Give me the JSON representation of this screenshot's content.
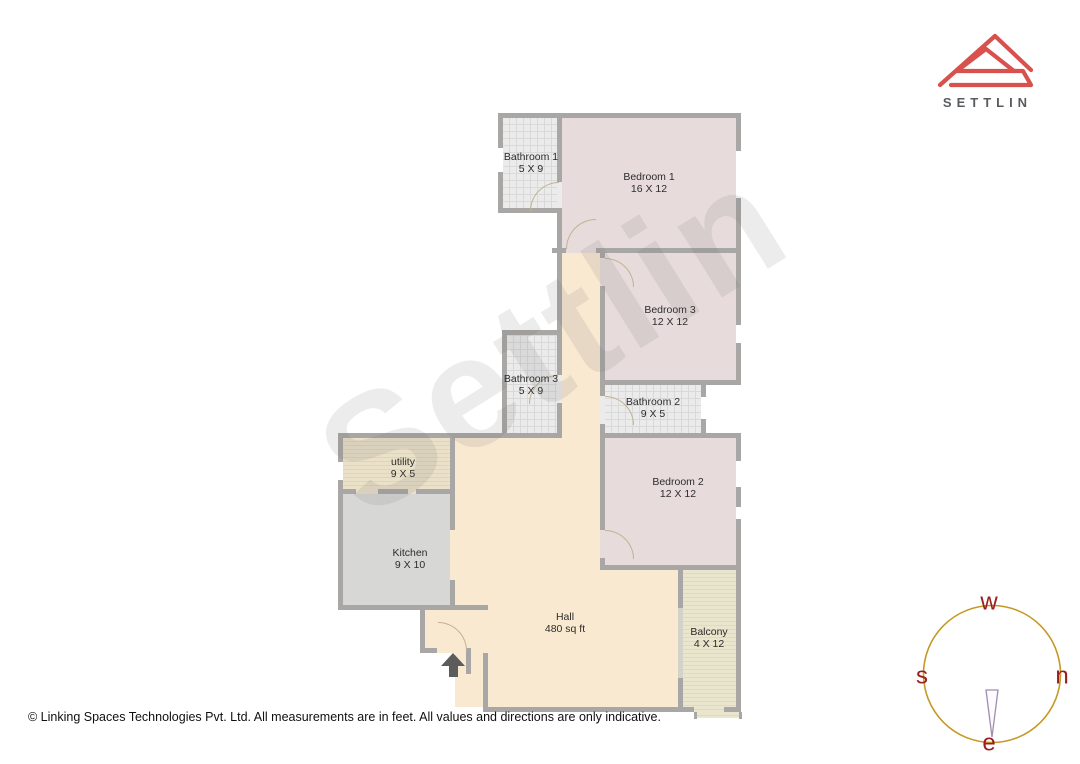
{
  "logo": {
    "brand": "SETTLIN",
    "icon_color": "#d8514c",
    "text_color": "#585c61"
  },
  "watermark": {
    "text": "Settlin"
  },
  "footer": {
    "copyright": "© Linking Spaces Technologies Pvt. Ltd. All measurements are in feet. All values and directions are only indicative."
  },
  "compass": {
    "labels": {
      "top": "w",
      "right": "n",
      "left": "s",
      "bottom": "e"
    },
    "circle_color": "#c49a24",
    "letter_color": "#9c1d1d",
    "needle_color": "#a18daf"
  },
  "floorplan": {
    "colors": {
      "wall": "#a8a7a5",
      "glass": "#d4d3ca",
      "arc": "#c2b294",
      "bedroom": "#e7dcdb",
      "bathroom": "#ebebeb",
      "bathroom_line": "#d9d9d9",
      "hall": "#f9e9d1",
      "utility": "#eae1c8",
      "utility_line": "#ded5b9",
      "kitchen": "#d7d7d6",
      "balcony": "#eae5cd",
      "balcony_line": "#ded9c1",
      "white": "#ffffff"
    },
    "rooms": [
      {
        "id": "bathroom-1",
        "type": "bathroom",
        "rect": [
          503,
          118,
          54,
          90
        ],
        "label": "Bathroom 1",
        "dims": "5 X 9",
        "label_xy": [
          531,
          152
        ]
      },
      {
        "id": "bedroom-1",
        "type": "bedroom",
        "rect": [
          562,
          118,
          174,
          130
        ],
        "label": "Bedroom 1",
        "dims": "16 X 12",
        "label_xy": [
          649,
          172
        ]
      },
      {
        "id": "corridor",
        "type": "hall",
        "rect": [
          562,
          253,
          38,
          185
        ]
      },
      {
        "id": "bedroom-3",
        "type": "bedroom",
        "rect": [
          605,
          253,
          131,
          127
        ],
        "label": "Bedroom 3",
        "dims": "12 X 12",
        "label_xy": [
          670,
          305
        ]
      },
      {
        "id": "bathroom-3",
        "type": "bathroom",
        "rect": [
          507,
          335,
          50,
          98
        ],
        "label": "Bathroom 3",
        "dims": "5 X 9",
        "label_xy": [
          531,
          374
        ]
      },
      {
        "id": "bathroom-2",
        "type": "bathroom",
        "rect": [
          605,
          385,
          96,
          48
        ],
        "label": "Bathroom 2",
        "dims": "9 X 5",
        "label_xy": [
          653,
          397
        ]
      },
      {
        "id": "bedroom-2",
        "type": "bedroom",
        "rect": [
          605,
          438,
          131,
          127
        ],
        "label": "Bedroom 2",
        "dims": "12 X 12",
        "label_xy": [
          678,
          477
        ]
      },
      {
        "id": "utility",
        "type": "utility",
        "rect": [
          343,
          438,
          107,
          51
        ],
        "label": "utility",
        "dims": "9 X 5",
        "label_xy": [
          403,
          457
        ]
      },
      {
        "id": "kitchen",
        "type": "kitchen",
        "rect": [
          343,
          494,
          107,
          111
        ],
        "label": "Kitchen",
        "dims": "9 X 10",
        "label_xy": [
          410,
          548
        ]
      },
      {
        "id": "hall-upper",
        "type": "hall",
        "rect": [
          455,
          438,
          145,
          132
        ]
      },
      {
        "id": "hall-main",
        "type": "hall",
        "rect": [
          455,
          570,
          223,
          137
        ],
        "label": "Hall",
        "dims": "480 sq ft",
        "label_xy": [
          565,
          612
        ]
      },
      {
        "id": "kitchen-doorway",
        "type": "hall",
        "rect": [
          450,
          530,
          5,
          50
        ]
      },
      {
        "id": "vestibule",
        "type": "hall",
        "rect": [
          425,
          610,
          63,
          40
        ]
      },
      {
        "id": "balcony",
        "type": "balcony",
        "rect": [
          683,
          570,
          53,
          142
        ],
        "label": "Balcony",
        "dims": "4 X 12",
        "label_xy": [
          709,
          627
        ]
      },
      {
        "id": "balcony-ledge",
        "type": "balcony",
        "rect": [
          696,
          712,
          46,
          6
        ]
      }
    ],
    "walls": [
      [
        498,
        113,
        243,
        5
      ],
      [
        498,
        208,
        64,
        5
      ],
      [
        552,
        248,
        14,
        5
      ],
      [
        596,
        248,
        145,
        5
      ],
      [
        502,
        330,
        60,
        5
      ],
      [
        600,
        380,
        141,
        5
      ],
      [
        338,
        433,
        224,
        5
      ],
      [
        600,
        433,
        141,
        5
      ],
      [
        338,
        489,
        18,
        5
      ],
      [
        378,
        489,
        30,
        5
      ],
      [
        416,
        489,
        39,
        5
      ],
      [
        600,
        565,
        141,
        5
      ],
      [
        338,
        605,
        150,
        5
      ],
      [
        420,
        648,
        17,
        5
      ],
      [
        483,
        707,
        211,
        5
      ],
      [
        724,
        707,
        17,
        5
      ],
      [
        498,
        113,
        5,
        35
      ],
      [
        498,
        172,
        5,
        41
      ],
      [
        557,
        113,
        5,
        69
      ],
      [
        557,
        208,
        5,
        167
      ],
      [
        557,
        403,
        5,
        35
      ],
      [
        502,
        330,
        5,
        108
      ],
      [
        600,
        253,
        5,
        5
      ],
      [
        600,
        286,
        5,
        110
      ],
      [
        600,
        424,
        5,
        106
      ],
      [
        600,
        558,
        5,
        12
      ],
      [
        701,
        385,
        5,
        12
      ],
      [
        701,
        419,
        5,
        19
      ],
      [
        736,
        113,
        5,
        38
      ],
      [
        736,
        198,
        5,
        127
      ],
      [
        736,
        343,
        5,
        42
      ],
      [
        736,
        438,
        5,
        23
      ],
      [
        736,
        487,
        5,
        20
      ],
      [
        736,
        519,
        5,
        193
      ],
      [
        338,
        433,
        5,
        29
      ],
      [
        338,
        480,
        5,
        125
      ],
      [
        450,
        433,
        5,
        97
      ],
      [
        450,
        580,
        5,
        25
      ],
      [
        420,
        605,
        5,
        45
      ],
      [
        466,
        648,
        5,
        26
      ],
      [
        483,
        653,
        5,
        59
      ],
      [
        678,
        565,
        5,
        43
      ],
      [
        678,
        678,
        5,
        34
      ],
      [
        694,
        712,
        3,
        7
      ],
      [
        739,
        712,
        3,
        7
      ]
    ],
    "glass_walls": [
      [
        678,
        608,
        5,
        70
      ]
    ],
    "door_gaps": [
      {
        "rect": [
          557,
          182,
          5,
          26
        ],
        "fill": "bathroom"
      },
      {
        "rect": [
          557,
          375,
          5,
          28
        ],
        "fill": "bathroom"
      },
      {
        "rect": [
          600,
          396,
          5,
          28
        ],
        "fill": "bathroom"
      },
      {
        "rect": [
          566,
          248,
          30,
          5
        ],
        "fill": "bedroom"
      },
      {
        "rect": [
          600,
          258,
          5,
          28
        ],
        "fill": "bedroom"
      },
      {
        "rect": [
          600,
          530,
          5,
          28
        ],
        "fill": "bedroom"
      },
      {
        "rect": [
          701,
          397,
          5,
          22
        ],
        "fill": "white"
      },
      {
        "rect": [
          356,
          489,
          22,
          5
        ],
        "fill": "utility"
      },
      {
        "rect": [
          408,
          489,
          8,
          5
        ],
        "fill": "utility"
      },
      {
        "rect": [
          437,
          648,
          29,
          5
        ],
        "fill": "hall"
      }
    ],
    "door_arcs": [
      {
        "x": 530,
        "y": 182,
        "r": 28,
        "corner": "tl"
      },
      {
        "x": 566,
        "y": 219,
        "r": 29,
        "corner": "tl"
      },
      {
        "x": 605,
        "y": 258,
        "r": 28,
        "corner": "tr"
      },
      {
        "x": 529,
        "y": 375,
        "r": 28,
        "corner": "tl"
      },
      {
        "x": 605,
        "y": 396,
        "r": 28,
        "corner": "tr"
      },
      {
        "x": 605,
        "y": 530,
        "r": 28,
        "corner": "tr"
      },
      {
        "x": 438,
        "y": 622,
        "r": 28,
        "corner": "tr"
      }
    ],
    "entrance_arrow": {
      "x": 441,
      "y": 653
    }
  }
}
